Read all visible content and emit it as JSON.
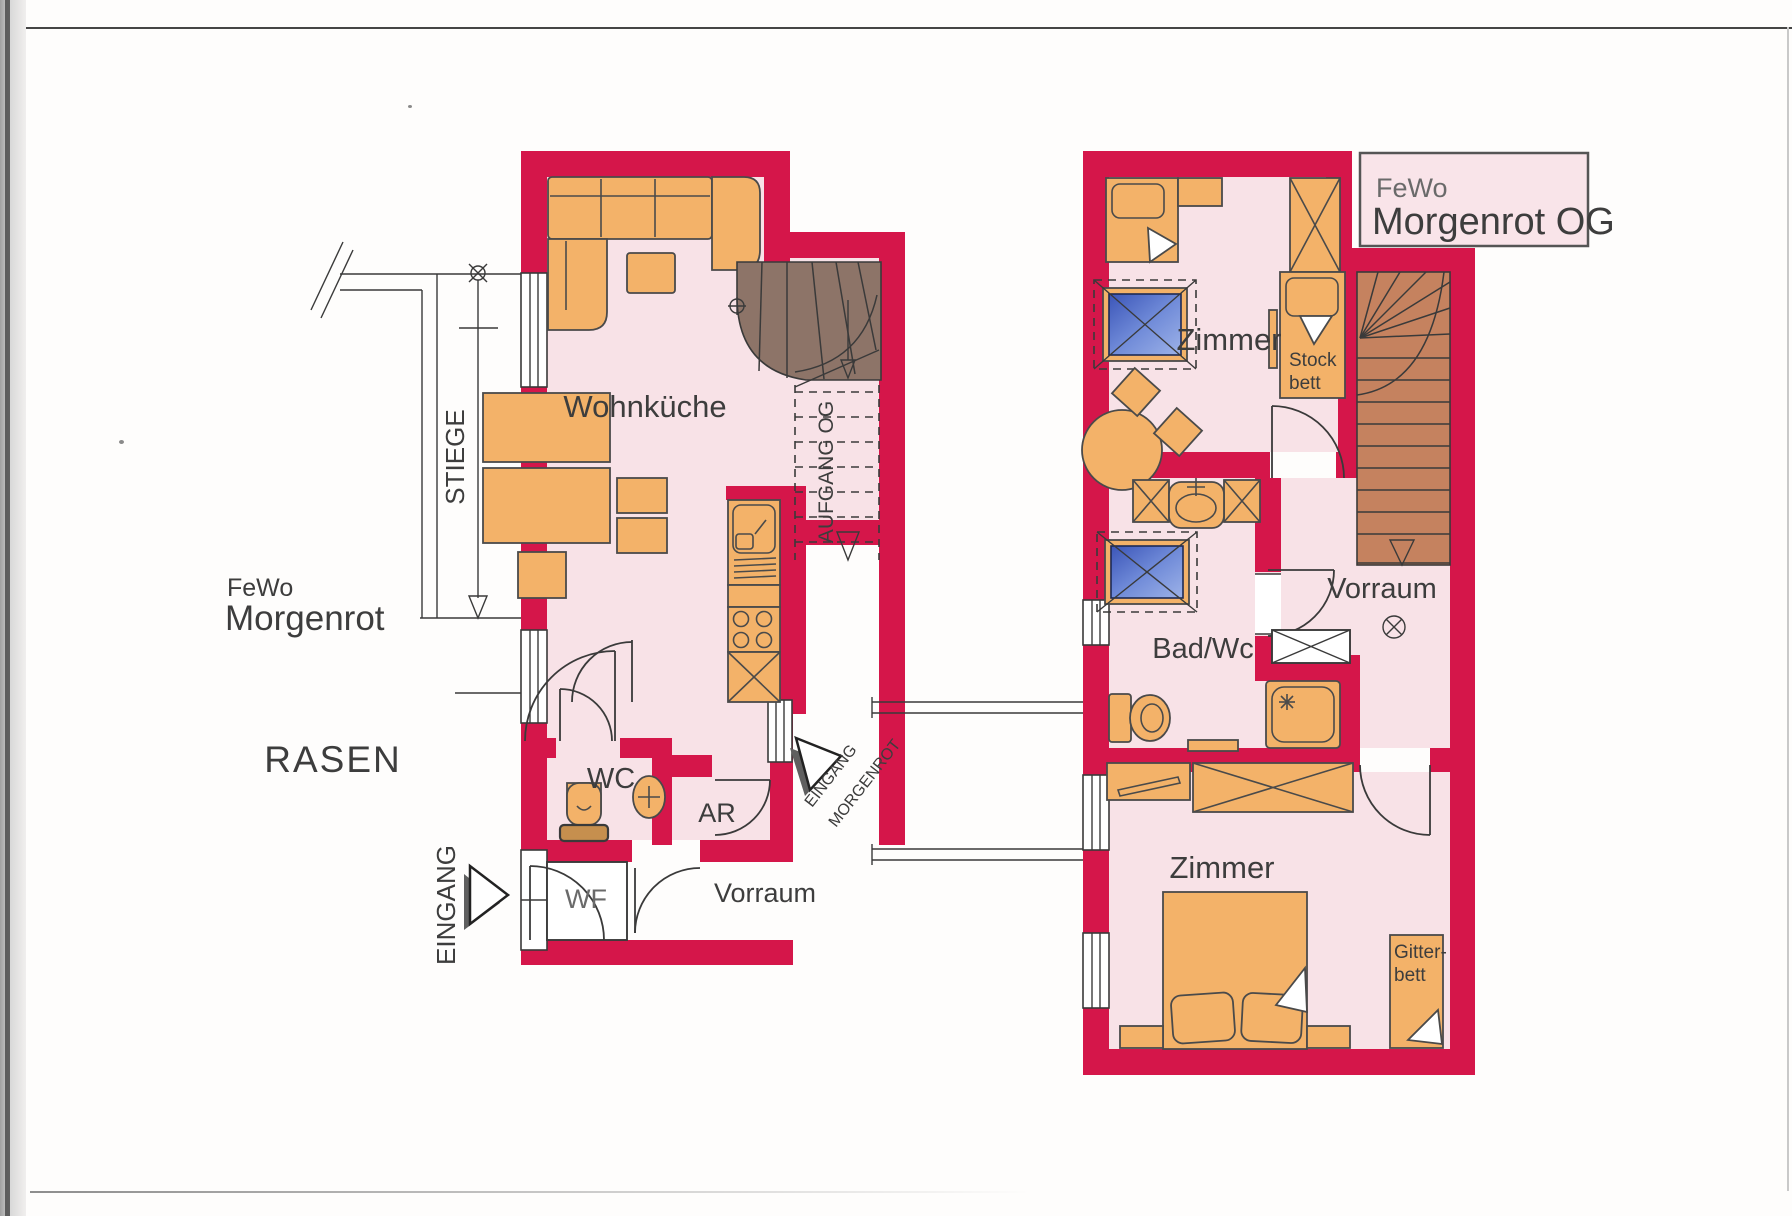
{
  "palette": {
    "wall_red": "#d5164a",
    "room_pink": "#f8e2e7",
    "furniture_orange": "#f3b269",
    "stairs_brown_ground": "#8d7468",
    "stairs_salmon_upper": "#c5825f",
    "skylight_blue": "#4b69c6",
    "line_dark": "#3a3a3a"
  },
  "ground_floor": {
    "apartment_label": {
      "line1": "FeWo",
      "line2": "Morgenrot"
    },
    "lawn_label": "RASEN",
    "entrance_label": "EINGANG",
    "exterior_stair_label": "STIEGE",
    "stair_up_label": "AUFGANG OG",
    "entrance_arrow_label": {
      "line1": "EINGANG",
      "line2": "MORGENROT"
    },
    "rooms": {
      "living_kitchen": "Wohnküche",
      "wc": "WC",
      "storage": "AR",
      "windbreak": "WF",
      "hall": "Vorraum"
    }
  },
  "upper_floor": {
    "title_box": {
      "line1": "FeWo",
      "line2": "Morgenrot OG"
    },
    "rooms": {
      "bedroom_top": "Zimmer",
      "bunk_bed": {
        "line1": "Stock",
        "line2": "bett"
      },
      "hall": "Vorraum",
      "bathroom": "Bad/Wc",
      "bedroom_bottom": "Zimmer",
      "crib": {
        "line1": "Gitter-",
        "line2": "bett"
      }
    }
  }
}
